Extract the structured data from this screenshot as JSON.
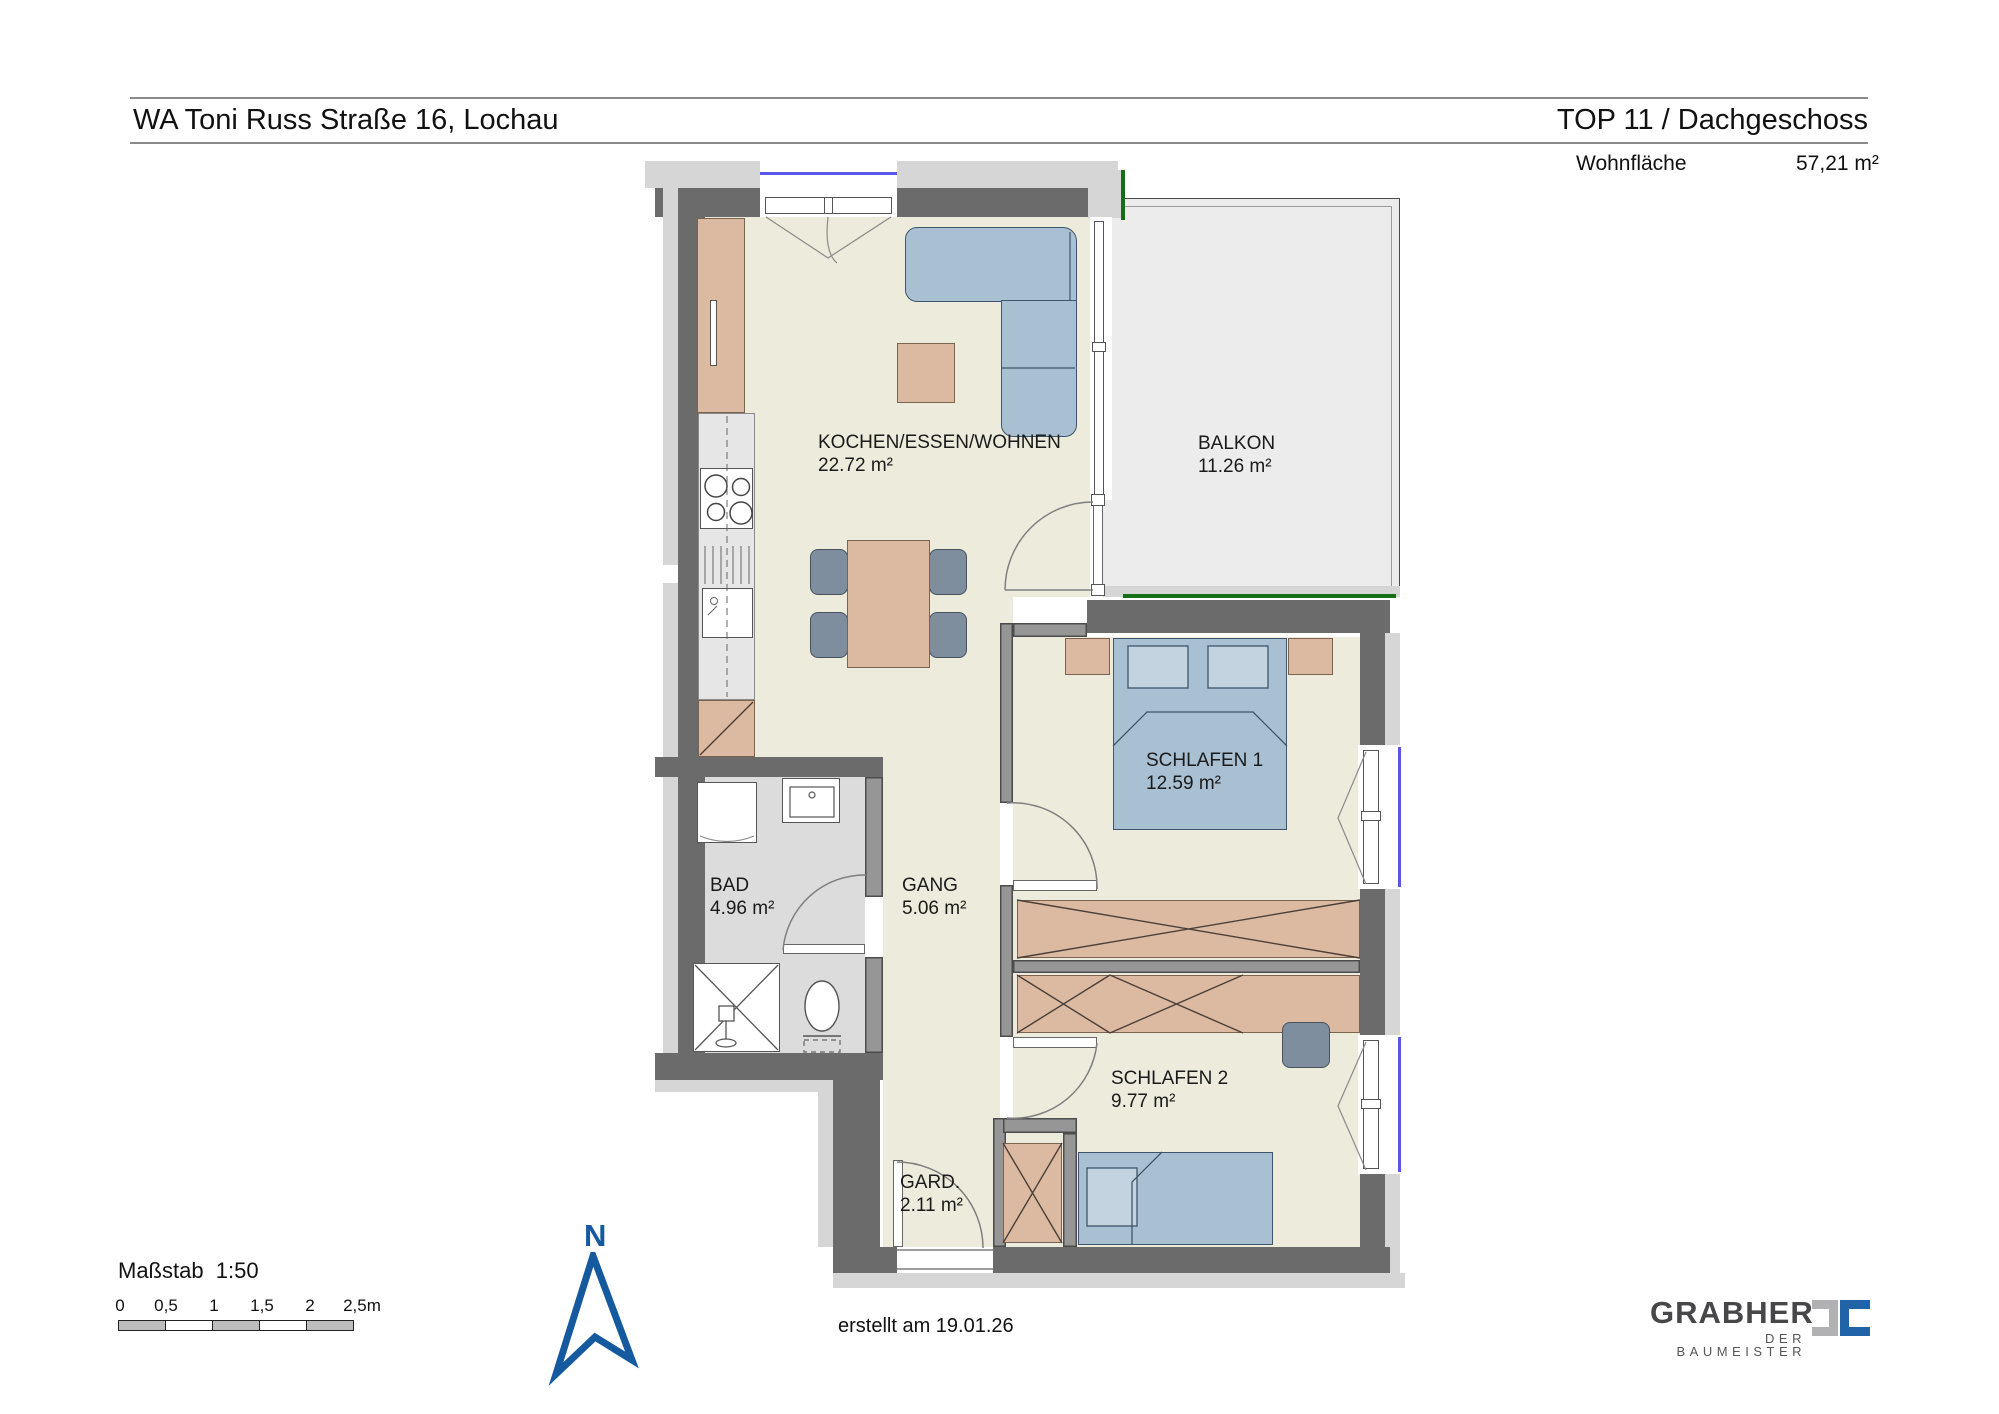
{
  "header": {
    "project": "WA Toni Russ Straße 16, Lochau",
    "unit": "TOP 11 / Dachgeschoss",
    "area_label": "Wohnfläche",
    "area_value": "57,21 m²"
  },
  "rooms": [
    {
      "name": "KOCHEN/ESSEN/WOHNEN",
      "area": "22.72 m²"
    },
    {
      "name": "BALKON",
      "area": "11.26 m²"
    },
    {
      "name": "SCHLAFEN 1",
      "area": "12.59 m²"
    },
    {
      "name": "BAD",
      "area": "4.96 m²"
    },
    {
      "name": "GANG",
      "area": "5.06 m²"
    },
    {
      "name": "SCHLAFEN 2",
      "area": "9.77 m²"
    },
    {
      "name": "GARD.",
      "area": "2.11 m²"
    }
  ],
  "scale": {
    "label": "Maßstab  1:50",
    "ticks": [
      "0",
      "0,5",
      "1",
      "1,5",
      "2",
      "2,5m"
    ]
  },
  "compass": {
    "label": "N"
  },
  "footer": {
    "created": "erstellt am 19.01.26"
  },
  "logo": {
    "name": "GRABHER",
    "tagline": "DER BAUMEISTER"
  },
  "colors": {
    "wall_dark": "#6b6b6b",
    "wall_interior": "#969696",
    "insulation": "#d6d6d6",
    "floor_main": "#edecdc",
    "floor_bath": "#dcdcdc",
    "floor_balcony": "#ececec",
    "furniture_wood": "#dcbaa2",
    "furniture_blue": "#a9c0d3",
    "chair_gray": "#7e8e9e",
    "window_glass": "#5757e8",
    "balcony_green": "#157015",
    "north_blue": "#15599f",
    "logo_gray": "#b1b1b3",
    "logo_blue": "#2163a8"
  }
}
